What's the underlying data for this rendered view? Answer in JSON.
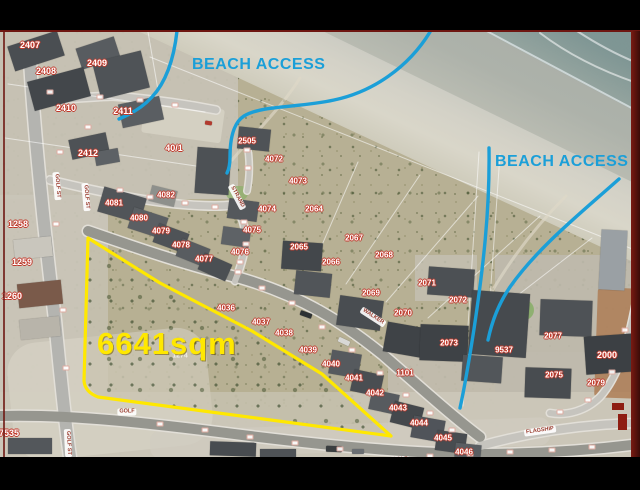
{
  "annotations": {
    "area_label": "6641sqm",
    "beach_access_left": "BEACH ACCESS",
    "beach_access_right": "BEACH ACCESS",
    "faint_plot": "1274"
  },
  "colors": {
    "annotation_cyan": "#1B9FD8",
    "annotation_yellow": "#FFE800",
    "plot_number_red": "#C0392B"
  },
  "plot_labels": [
    {
      "text": "2407",
      "x": 30,
      "y": 45,
      "size": 9
    },
    {
      "text": "2408",
      "x": 46,
      "y": 71,
      "size": 9
    },
    {
      "text": "2409",
      "x": 97,
      "y": 63,
      "size": 9
    },
    {
      "text": "2410",
      "x": 66,
      "y": 108,
      "size": 9
    },
    {
      "text": "2411",
      "x": 123,
      "y": 111,
      "size": 9
    },
    {
      "text": "2412",
      "x": 88,
      "y": 153,
      "size": 9
    },
    {
      "text": "40/1",
      "x": 174,
      "y": 148,
      "size": 9
    },
    {
      "text": "2505",
      "x": 247,
      "y": 141,
      "size": 8
    },
    {
      "text": "4072",
      "x": 274,
      "y": 159,
      "size": 8
    },
    {
      "text": "4073",
      "x": 298,
      "y": 181,
      "size": 8
    },
    {
      "text": "2064",
      "x": 314,
      "y": 209,
      "size": 8
    },
    {
      "text": "4074",
      "x": 267,
      "y": 209,
      "size": 8
    },
    {
      "text": "4075",
      "x": 252,
      "y": 230,
      "size": 8
    },
    {
      "text": "4076",
      "x": 240,
      "y": 252,
      "size": 8
    },
    {
      "text": "2065",
      "x": 299,
      "y": 247,
      "size": 8
    },
    {
      "text": "2066",
      "x": 331,
      "y": 262,
      "size": 8
    },
    {
      "text": "2067",
      "x": 354,
      "y": 238,
      "size": 8
    },
    {
      "text": "2068",
      "x": 384,
      "y": 255,
      "size": 8
    },
    {
      "text": "4082",
      "x": 166,
      "y": 195,
      "size": 8
    },
    {
      "text": "4081",
      "x": 114,
      "y": 203,
      "size": 8
    },
    {
      "text": "4080",
      "x": 139,
      "y": 218,
      "size": 8
    },
    {
      "text": "4079",
      "x": 161,
      "y": 231,
      "size": 8
    },
    {
      "text": "4078",
      "x": 181,
      "y": 245,
      "size": 8
    },
    {
      "text": "4077",
      "x": 204,
      "y": 259,
      "size": 8
    },
    {
      "text": "1258",
      "x": 18,
      "y": 224,
      "size": 9
    },
    {
      "text": "1259",
      "x": 22,
      "y": 262,
      "size": 9
    },
    {
      "text": "1260",
      "x": 12,
      "y": 296,
      "size": 9
    },
    {
      "text": "4036",
      "x": 226,
      "y": 308,
      "size": 8
    },
    {
      "text": "4037",
      "x": 261,
      "y": 322,
      "size": 8
    },
    {
      "text": "4038",
      "x": 284,
      "y": 333,
      "size": 8
    },
    {
      "text": "4039",
      "x": 308,
      "y": 350,
      "size": 8
    },
    {
      "text": "4040",
      "x": 331,
      "y": 364,
      "size": 8
    },
    {
      "text": "4041",
      "x": 354,
      "y": 378,
      "size": 8
    },
    {
      "text": "4042",
      "x": 375,
      "y": 393,
      "size": 8
    },
    {
      "text": "2069",
      "x": 371,
      "y": 293,
      "size": 8
    },
    {
      "text": "2070",
      "x": 403,
      "y": 313,
      "size": 8
    },
    {
      "text": "1101",
      "x": 405,
      "y": 373,
      "size": 8
    },
    {
      "text": "4043",
      "x": 398,
      "y": 408,
      "size": 8
    },
    {
      "text": "4044",
      "x": 419,
      "y": 423,
      "size": 8
    },
    {
      "text": "4045",
      "x": 443,
      "y": 438,
      "size": 8
    },
    {
      "text": "4046",
      "x": 464,
      "y": 452,
      "size": 8
    },
    {
      "text": "2071",
      "x": 427,
      "y": 283,
      "size": 8
    },
    {
      "text": "2072",
      "x": 458,
      "y": 300,
      "size": 8
    },
    {
      "text": "2073",
      "x": 449,
      "y": 343,
      "size": 8
    },
    {
      "text": "9537",
      "x": 504,
      "y": 350,
      "size": 8
    },
    {
      "text": "2077",
      "x": 553,
      "y": 336,
      "size": 8
    },
    {
      "text": "2000",
      "x": 607,
      "y": 355,
      "size": 9
    },
    {
      "text": "2075",
      "x": 554,
      "y": 375,
      "size": 8
    },
    {
      "text": "2079",
      "x": 596,
      "y": 383,
      "size": 8
    },
    {
      "text": "7535",
      "x": 9,
      "y": 433,
      "size": 9
    }
  ],
  "street_labels": [
    {
      "text": "GOLF",
      "x": 127,
      "y": 412,
      "rot": 0
    },
    {
      "text": "GOLF",
      "x": 400,
      "y": 460,
      "rot": -2
    },
    {
      "text": "FLAGSHIP",
      "x": 540,
      "y": 431,
      "rot": -8
    },
    {
      "text": "WALKER",
      "x": 373,
      "y": 317,
      "rot": 33
    },
    {
      "text": "STRAND",
      "x": 237,
      "y": 197,
      "rot": 62
    },
    {
      "text": "GOLF ST",
      "x": 57,
      "y": 186,
      "rot": 85
    },
    {
      "text": "GOLF ST",
      "x": 86,
      "y": 197,
      "rot": 85
    },
    {
      "text": "GOLF ST",
      "x": 68,
      "y": 443,
      "rot": 87
    }
  ]
}
